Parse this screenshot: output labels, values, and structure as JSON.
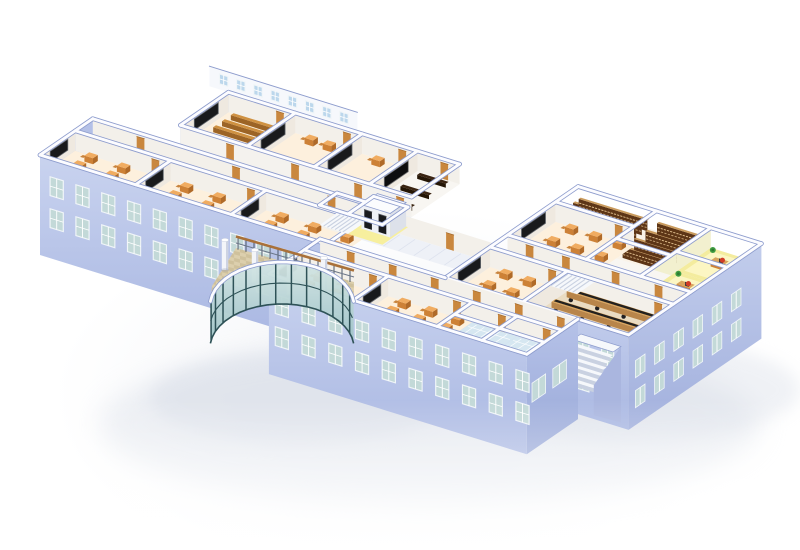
{
  "scene": {
    "background": "#ffffff",
    "render_type": "isometric-building-cutaway"
  },
  "palette": {
    "wall_top": "#fcfcff",
    "wall_edge": "#8d9ccd",
    "facade_hi": "#c9d3ef",
    "facade_lo": "#a9b7e2",
    "facade_dark_hi": "#b6c2e8",
    "facade_dark_lo": "#98a8d8",
    "se_hi": "#c2cdec",
    "se_lo": "#a2b0dd",
    "interior_face": "#f3f0ea",
    "interior_face_warm": "#efe9e0",
    "floor": "#f8f6f2",
    "floor_warm": "#fdf0dd",
    "corridor": "#eef1f7",
    "corridor_line": "#dde2ee",
    "courtyard": "#e8eef8",
    "courtyard_line": "#dfe8f5",
    "window_frame": "#f0f5f8",
    "window_glass": "#c3d9d8",
    "window_glass_blue": "#bcd7ec",
    "glass_hi": "#d4e6e4",
    "glass_lo": "#9dc2c6",
    "mullion": "#2e5257",
    "tile": "#dccfad",
    "tile_dark": "#cfc19c",
    "column": "#f3f5f9",
    "column_shade": "#bcc5d9",
    "rail_wood": "#a9713a",
    "rail_post": "#4a5668",
    "desk": "#f0ac61",
    "desk_front": "#cd8136",
    "desk_dark": "#b06a28",
    "seat_tan": "#c9853f",
    "cabinet": "#9a6130",
    "cabinet_front": "#7c4a22",
    "cabinet_dark": "#5d3315",
    "blackboard": "#191a1c",
    "blackboard_frame": "#63676d",
    "door": "#c9873e",
    "door_dark": "#a3682a",
    "shelf": "#5d3516",
    "shelf_light": "#c99a5c",
    "shelf_specks": "#e8c795",
    "bench": "#cf9141",
    "bench_front": "#9c6426",
    "seat_dark": "#3a2412",
    "seat_dark_front": "#241505",
    "screen_dark": "#0d0d0f",
    "lab_floor": "#eadcc2",
    "lab_desk": "#d9a55e",
    "lab_desk_front": "#b8854a",
    "lab_top": "#23211f",
    "chair_black": "#1f1f22",
    "office_floor": "#f4ec9e",
    "office_glow": "#fdf8c9",
    "chair_red": "#d13c26",
    "plant": "#3f9c41",
    "plant_dark": "#2e7a30",
    "restroom": "#d6e7f1",
    "restroom_line": "#ffffff",
    "stair": "#f6f8fb",
    "stair_shade": "#c9d1e1",
    "yellow_floor": "#f7ef9e",
    "elevator_door": "#1a1b1f",
    "shadow": "#e3e7ee",
    "shadow_dark": "#d9dee8"
  },
  "floorplan": {
    "wings": [
      {
        "id": "wing-b",
        "label": "north-classroom-wing",
        "rooms": [
          {
            "type": "lecture",
            "name": "tiered-lecture-room",
            "u": [
              70,
              140
            ],
            "v": [
              92,
              152
            ]
          },
          {
            "type": "classroom",
            "name": "classroom",
            "u": [
              140,
              210
            ],
            "v": [
              92,
              152
            ],
            "desks": [
              3,
              2
            ]
          },
          {
            "type": "classroom",
            "name": "classroom",
            "u": [
              210,
              268
            ],
            "v": [
              92,
              152
            ],
            "desks": [
              2,
              2
            ]
          },
          {
            "type": "darkhall",
            "name": "av-lecture-room",
            "u": [
              268,
              312
            ],
            "v": [
              92,
              152
            ]
          }
        ]
      },
      {
        "id": "wing-a",
        "label": "west-classroom-wing",
        "rooms": [
          {
            "type": "classroom",
            "name": "classroom",
            "u": [
              0,
              100
            ],
            "v": [
              0,
              44
            ],
            "desks": [
              3,
              3
            ]
          },
          {
            "type": "classroom",
            "name": "classroom",
            "u": [
              100,
              200
            ],
            "v": [
              0,
              44
            ],
            "desks": [
              3,
              3
            ]
          },
          {
            "type": "classroom",
            "name": "classroom",
            "u": [
              200,
              300
            ],
            "v": [
              0,
              44
            ],
            "desks": [
              3,
              3
            ]
          }
        ]
      },
      {
        "id": "block-c",
        "label": "east-block",
        "rooms": [
          {
            "type": "library",
            "name": "library-stacks",
            "u": [
              421,
              503
            ],
            "v": [
              142,
              170
            ]
          },
          {
            "type": "library",
            "name": "library-stacks",
            "u": [
              503,
              560
            ],
            "v": [
              120,
              170
            ]
          },
          {
            "type": "office",
            "name": "staff-office",
            "u": [
              560,
              613
            ],
            "v": [
              127,
              170
            ]
          },
          {
            "type": "office",
            "name": "staff-office",
            "u": [
              560,
              613
            ],
            "v": [
              85,
              127
            ]
          },
          {
            "type": "classroom",
            "name": "classroom",
            "u": [
              421,
              503
            ],
            "v": [
              82,
              142
            ],
            "desks": [
              3,
              3
            ]
          },
          {
            "type": "plain",
            "name": "open-room",
            "u": [
              503,
              560
            ],
            "v": [
              82,
              120
            ]
          },
          {
            "type": "classroom",
            "name": "classroom",
            "u": [
              421,
              502
            ],
            "v": [
              4,
              60
            ],
            "desks": [
              3,
              3
            ]
          },
          {
            "type": "lab",
            "name": "computer-lab",
            "u": [
              502,
              613
            ],
            "v": [
              4,
              60
            ]
          }
        ]
      },
      {
        "id": "wing-d",
        "label": "south-classroom-wing",
        "rooms": [
          {
            "type": "classroom",
            "name": "classroom",
            "u": [
              290,
              378
            ],
            "v": [
              -60,
              -16
            ],
            "desks": [
              3,
              3
            ]
          },
          {
            "type": "classroom",
            "name": "classroom",
            "u": [
              378,
              466
            ],
            "v": [
              -60,
              -16
            ],
            "desks": [
              3,
              3
            ]
          },
          {
            "type": "restroom",
            "name": "washroom",
            "u": [
              466,
              513
            ],
            "v": [
              -60,
              -16
            ]
          },
          {
            "type": "restroom",
            "name": "washroom",
            "u": [
              513,
              560
            ],
            "v": [
              -60,
              -16
            ]
          }
        ]
      }
    ],
    "corridors": [
      {
        "name": "west-corridor",
        "u": [
          0,
          312
        ],
        "v": [
          44,
          66
        ]
      },
      {
        "name": "link-corridor",
        "u": [
          312,
          421
        ],
        "v": [
          44,
          66
        ]
      },
      {
        "name": "east-corridor",
        "u": [
          421,
          613
        ],
        "v": [
          60,
          82
        ]
      },
      {
        "name": "south-corridor",
        "u": [
          290,
          560
        ],
        "v": [
          -16,
          4
        ]
      }
    ],
    "courtyard": {
      "name": "link-roof",
      "u": [
        0,
        312
      ],
      "v": [
        66,
        92
      ]
    },
    "features": [
      "glass-rotunda-lobby",
      "elevator-core",
      "interior-stair",
      "exterior-stair"
    ]
  }
}
